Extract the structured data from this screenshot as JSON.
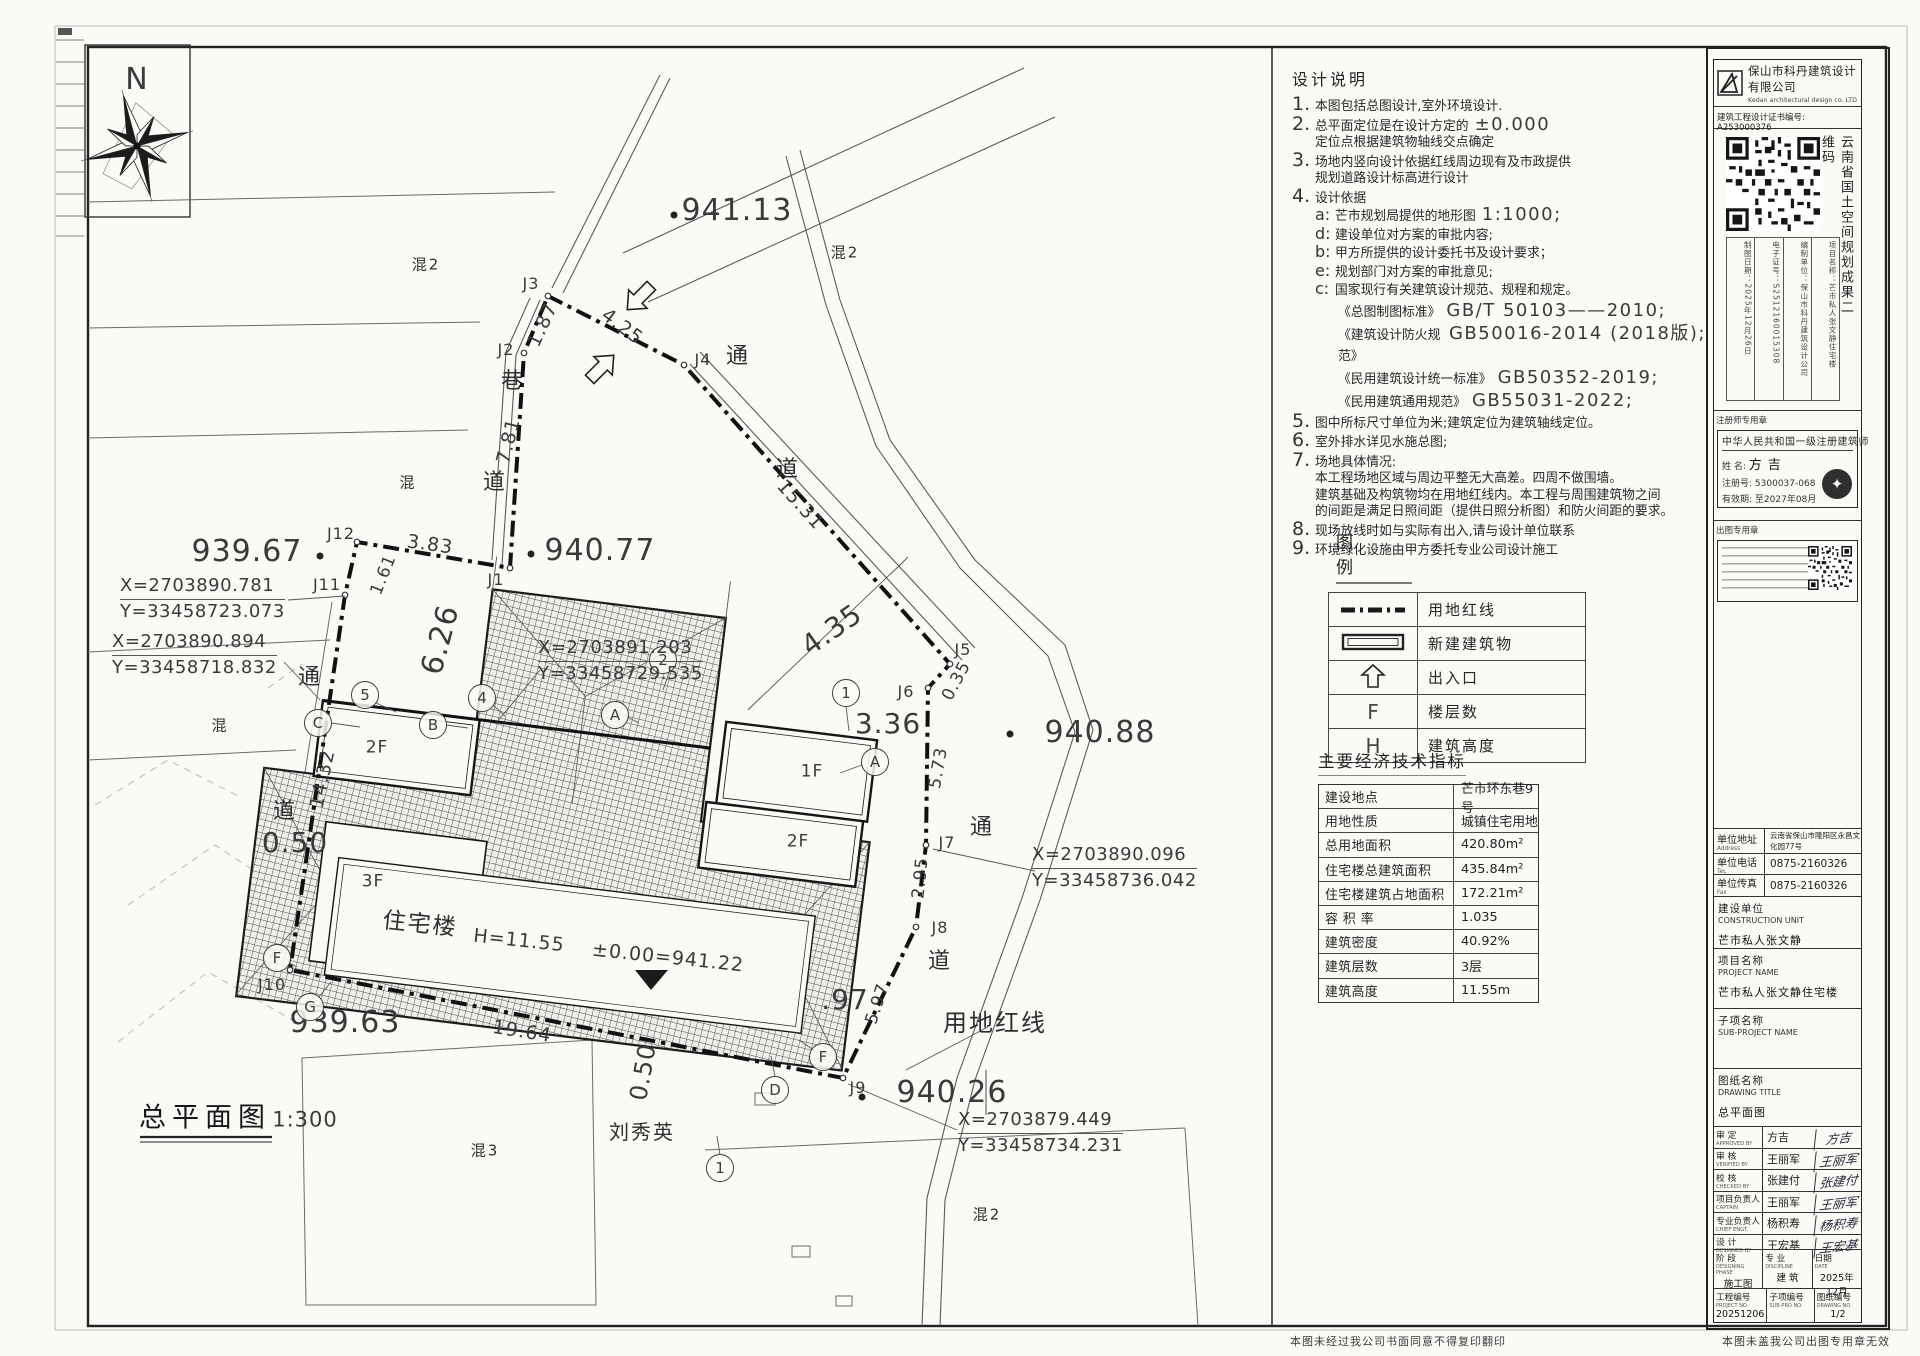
{
  "plan": {
    "north_label": "N",
    "labels": [
      {
        "t": "941.13",
        "x": 737,
        "y": 211,
        "s": 30,
        "name": "spot-elevation"
      },
      {
        "t": "940.77",
        "x": 600,
        "y": 551,
        "s": 30,
        "name": "spot-elevation"
      },
      {
        "t": "939.67",
        "x": 247,
        "y": 552,
        "s": 30,
        "name": "spot-elevation"
      },
      {
        "t": "940.88",
        "x": 1100,
        "y": 733,
        "s": 30,
        "name": "spot-elevation"
      },
      {
        "t": "939.63",
        "x": 345,
        "y": 1023,
        "s": 30,
        "name": "spot-elevation"
      },
      {
        "t": "940.26",
        "x": 952,
        "y": 1093,
        "s": 30,
        "name": "spot-elevation"
      },
      {
        "t": ".97",
        "x": 845,
        "y": 1000,
        "s": 28,
        "name": "spot-elevation"
      },
      {
        "t": "6.26",
        "x": 441,
        "y": 640,
        "s": 30,
        "r": -75,
        "name": "dimension"
      },
      {
        "t": "4.35",
        "x": 832,
        "y": 630,
        "s": 28,
        "r": -35,
        "name": "dimension"
      },
      {
        "t": "3.36",
        "x": 888,
        "y": 724,
        "s": 28,
        "name": "dimension"
      },
      {
        "t": "0.50",
        "x": 295,
        "y": 843,
        "s": 28,
        "name": "dimension"
      },
      {
        "t": "0.50",
        "x": 643,
        "y": 1072,
        "s": 24,
        "r": -80,
        "name": "dimension"
      },
      {
        "t": "1.87",
        "x": 543,
        "y": 325,
        "s": 19,
        "r": -65,
        "name": "dimension"
      },
      {
        "t": "4.25",
        "x": 622,
        "y": 327,
        "s": 19,
        "r": 37,
        "name": "dimension"
      },
      {
        "t": "15.31",
        "x": 800,
        "y": 505,
        "s": 19,
        "r": 48,
        "name": "dimension"
      },
      {
        "t": "0.35",
        "x": 957,
        "y": 681,
        "s": 17,
        "r": -62,
        "name": "dimension"
      },
      {
        "t": "5.73",
        "x": 939,
        "y": 768,
        "s": 17,
        "r": -80,
        "name": "dimension"
      },
      {
        "t": "2.95",
        "x": 921,
        "y": 878,
        "s": 17,
        "r": -84,
        "name": "dimension"
      },
      {
        "t": "5.97",
        "x": 878,
        "y": 1004,
        "s": 17,
        "r": -72,
        "name": "dimension"
      },
      {
        "t": "19.64",
        "x": 522,
        "y": 1032,
        "s": 19,
        "r": 9,
        "name": "dimension"
      },
      {
        "t": "14.32",
        "x": 323,
        "y": 779,
        "s": 19,
        "r": -78,
        "name": "dimension"
      },
      {
        "t": "3.83",
        "x": 430,
        "y": 545,
        "s": 19,
        "r": 8,
        "name": "dimension"
      },
      {
        "t": "1.61",
        "x": 384,
        "y": 575,
        "s": 17,
        "r": -68,
        "name": "dimension"
      },
      {
        "t": "7.81",
        "x": 509,
        "y": 441,
        "s": 19,
        "r": -76,
        "name": "dimension"
      },
      {
        "t": "J1",
        "x": 496,
        "y": 580,
        "s": 16,
        "name": "boundary-point-label"
      },
      {
        "t": "J2",
        "x": 506,
        "y": 350,
        "s": 16,
        "name": "boundary-point-label"
      },
      {
        "t": "J3",
        "x": 531,
        "y": 284,
        "s": 16,
        "name": "boundary-point-label"
      },
      {
        "t": "J4",
        "x": 703,
        "y": 360,
        "s": 16,
        "name": "boundary-point-label"
      },
      {
        "t": "J5",
        "x": 963,
        "y": 650,
        "s": 16,
        "name": "boundary-point-label"
      },
      {
        "t": "J6",
        "x": 906,
        "y": 692,
        "s": 16,
        "name": "boundary-point-label"
      },
      {
        "t": "J7",
        "x": 947,
        "y": 843,
        "s": 16,
        "name": "boundary-point-label"
      },
      {
        "t": "J8",
        "x": 940,
        "y": 928,
        "s": 16,
        "name": "boundary-point-label"
      },
      {
        "t": "J9",
        "x": 858,
        "y": 1088,
        "s": 16,
        "name": "boundary-point-label"
      },
      {
        "t": "J10",
        "x": 272,
        "y": 985,
        "s": 16,
        "name": "boundary-point-label"
      },
      {
        "t": "J11",
        "x": 327,
        "y": 585,
        "s": 16,
        "name": "boundary-point-label"
      },
      {
        "t": "J12",
        "x": 341,
        "y": 534,
        "s": 16,
        "name": "boundary-point-label"
      },
      {
        "t": "N",
        "x": 137,
        "y": 80,
        "s": 30,
        "name": "north-letter"
      },
      {
        "t": "巷",
        "x": 513,
        "y": 382,
        "s": 22,
        "c": "cn",
        "name": "road-label"
      },
      {
        "t": "道",
        "x": 495,
        "y": 483,
        "s": 22,
        "c": "cn",
        "name": "road-label"
      },
      {
        "t": "通",
        "x": 738,
        "y": 357,
        "s": 22,
        "c": "cn",
        "name": "road-label"
      },
      {
        "t": "道",
        "x": 788,
        "y": 470,
        "s": 22,
        "c": "cn",
        "name": "road-label"
      },
      {
        "t": "通",
        "x": 310,
        "y": 678,
        "s": 22,
        "c": "cn",
        "name": "road-label"
      },
      {
        "t": "道",
        "x": 285,
        "y": 812,
        "s": 22,
        "c": "cn",
        "name": "road-label"
      },
      {
        "t": "通",
        "x": 982,
        "y": 828,
        "s": 22,
        "c": "cn",
        "name": "road-label"
      },
      {
        "t": "道",
        "x": 940,
        "y": 962,
        "s": 22,
        "c": "cn",
        "name": "road-label"
      },
      {
        "t": "混2",
        "x": 426,
        "y": 265,
        "s": 15,
        "c": "cn",
        "name": "parcel-label"
      },
      {
        "t": "混2",
        "x": 845,
        "y": 253,
        "s": 15,
        "c": "cn",
        "name": "parcel-label"
      },
      {
        "t": "混",
        "x": 408,
        "y": 483,
        "s": 15,
        "c": "cn",
        "name": "parcel-label"
      },
      {
        "t": "混",
        "x": 220,
        "y": 726,
        "s": 15,
        "c": "cn",
        "name": "parcel-label"
      },
      {
        "t": "混3",
        "x": 485,
        "y": 1151,
        "s": 15,
        "c": "cn",
        "name": "parcel-label"
      },
      {
        "t": "混2",
        "x": 987,
        "y": 1215,
        "s": 15,
        "c": "cn",
        "name": "parcel-label"
      },
      {
        "t": "刘秀英",
        "x": 642,
        "y": 1132,
        "s": 20,
        "c": "cn",
        "name": "neighbor-owner-label"
      },
      {
        "t": "用地红线",
        "x": 995,
        "y": 1023,
        "s": 24,
        "c": "cn",
        "name": "red-line-label"
      },
      {
        "t": "住宅楼",
        "x": 420,
        "y": 925,
        "s": 23,
        "r": 6,
        "c": "cn",
        "name": "building-name"
      },
      {
        "t": "H=11.55",
        "x": 519,
        "y": 941,
        "s": 19,
        "r": 6,
        "name": "building-height"
      },
      {
        "t": "±0.00=941.22",
        "x": 668,
        "y": 958,
        "s": 19,
        "r": 6,
        "name": "building-datum"
      },
      {
        "t": "2F",
        "x": 377,
        "y": 748,
        "s": 17,
        "name": "floor-label"
      },
      {
        "t": "3F",
        "x": 373,
        "y": 882,
        "s": 17,
        "name": "floor-label"
      },
      {
        "t": "1F",
        "x": 812,
        "y": 772,
        "s": 17,
        "name": "floor-label"
      },
      {
        "t": "2F",
        "x": 798,
        "y": 842,
        "s": 17,
        "name": "floor-label"
      },
      {
        "t": "总平面图",
        "x": 205,
        "y": 1118,
        "s": 27,
        "c": "cnb",
        "name": "drawing-title-label"
      },
      {
        "t": "1:300",
        "x": 305,
        "y": 1120,
        "s": 21,
        "name": "drawing-scale"
      }
    ],
    "bubbles": [
      {
        "t": "C",
        "x": 318,
        "y": 723
      },
      {
        "t": "5",
        "x": 365,
        "y": 695
      },
      {
        "t": "B",
        "x": 433,
        "y": 725
      },
      {
        "t": "4",
        "x": 482,
        "y": 698
      },
      {
        "t": "A",
        "x": 615,
        "y": 715
      },
      {
        "t": "2",
        "x": 663,
        "y": 660
      },
      {
        "t": "1",
        "x": 846,
        "y": 693
      },
      {
        "t": "A",
        "x": 875,
        "y": 762
      },
      {
        "t": "D",
        "x": 775,
        "y": 1090
      },
      {
        "t": "G",
        "x": 310,
        "y": 1007
      },
      {
        "t": "F",
        "x": 277,
        "y": 958
      },
      {
        "t": "F",
        "x": 823,
        "y": 1057
      },
      {
        "t": "1",
        "x": 720,
        "y": 1168
      }
    ],
    "coord_blocks": [
      {
        "x1": "X=2703890.781",
        "y1": "Y=33458723.073",
        "px": 120,
        "py": 574
      },
      {
        "x1": "X=2703890.894",
        "y1": "Y=33458718.832",
        "px": 112,
        "py": 630
      },
      {
        "x1": "X=2703891.203",
        "y1": "Y=33458729.535",
        "px": 538,
        "py": 636
      },
      {
        "x1": "X=2703890.096",
        "y1": "Y=33458736.042",
        "px": 1032,
        "py": 843
      },
      {
        "x1": "X=2703879.449",
        "y1": "Y=33458734.231",
        "px": 958,
        "py": 1108
      }
    ]
  },
  "notes": {
    "title": "设计说明",
    "items": [
      {
        "k": "n",
        "n": "1.",
        "t": "本图包括总图设计,室外环境设计."
      },
      {
        "k": "n",
        "n": "2.",
        "t": "总平面定位是在设计方定的",
        "code": "±0.000"
      },
      {
        "k": "c",
        "t": "定位点根据建筑物轴线交点确定"
      },
      {
        "k": "n",
        "n": "3.",
        "t": "场地内竖向设计依据红线周边现有及市政提供"
      },
      {
        "k": "c",
        "t": "规划道路设计标高进行设计"
      },
      {
        "k": "n",
        "n": "4.",
        "t": "设计依据"
      },
      {
        "k": "s",
        "n": "a:",
        "t": "芒市规划局提供的地形图",
        "code": "1:1000;"
      },
      {
        "k": "s",
        "n": "d:",
        "t": "建设单位对方案的审批内容;"
      },
      {
        "k": "s",
        "n": "b:",
        "t": "甲方所提供的设计委托书及设计要求；"
      },
      {
        "k": "s",
        "n": "e:",
        "t": "规划部门对方案的审批意见;"
      },
      {
        "k": "s",
        "n": "c:",
        "t": "国家现行有关建筑设计规范、规程和规定。"
      },
      {
        "k": "std",
        "t": "《总图制图标准》",
        "code": "GB/T 50103——2010;"
      },
      {
        "k": "std",
        "t": "《建筑设计防火规范》",
        "code": "GB50016-2014 (2018版);"
      },
      {
        "k": "std",
        "t": "《民用建筑设计统一标准》",
        "code": "GB50352-2019;"
      },
      {
        "k": "std",
        "t": "《民用建筑通用规范》",
        "code": "GB55031-2022;"
      },
      {
        "k": "n",
        "n": "5.",
        "t": "图中所标尺寸单位为米;建筑定位为建筑轴线定位。"
      },
      {
        "k": "n",
        "n": "6.",
        "t": "室外排水详见水施总图;"
      },
      {
        "k": "n",
        "n": "7.",
        "t": "场地具体情况:"
      },
      {
        "k": "c",
        "t": "本工程场地区域与周边平整无大高差。四周不做围墙。"
      },
      {
        "k": "c",
        "t": "建筑基础及构筑物均在用地红线内。本工程与周围建筑物之间"
      },
      {
        "k": "c",
        "t": "的间距是满足日照间距（提供日照分析图）和防火间距的要求。"
      },
      {
        "k": "n",
        "n": "8.",
        "t": "现场放线时如与实际有出入,请与设计单位联系"
      },
      {
        "k": "n",
        "n": "9.",
        "t": "环境绿化设施由甲方委托专业公司设计施工"
      }
    ]
  },
  "legend": {
    "title": "图  例",
    "rows": [
      {
        "label": "用地红线"
      },
      {
        "label": "新建建筑物"
      },
      {
        "label": "出入口"
      },
      {
        "label": "楼层数",
        "letter": "F"
      },
      {
        "label": "建筑高度",
        "letter": "H"
      }
    ]
  },
  "econ": {
    "title": "主要经济技术指标",
    "rows": [
      {
        "label": "建设地点",
        "value": "芒市环东巷9号"
      },
      {
        "label": "用地性质",
        "value": "城镇住宅用地"
      },
      {
        "label": "总用地面积",
        "value": "420.80m²"
      },
      {
        "label": "住宅楼总建筑面积",
        "value": "435.84m²"
      },
      {
        "label": "住宅楼建筑占地面积",
        "value": "172.21m²"
      },
      {
        "label": "容 积 率",
        "value": "1.035"
      },
      {
        "label": "建筑密度",
        "value": "40.92%"
      },
      {
        "label": "建筑层数",
        "value": "3层"
      },
      {
        "label": "建筑高度",
        "value": "11.55m"
      }
    ]
  },
  "titleblock": {
    "company_cn": "保山市科丹建筑设计有限公司",
    "company_en": "Kedan architectural design co. LTD",
    "cert": "建筑工程设计证书编号: A253000376",
    "qr_caption": "云南省国土空间规划成果二维码",
    "qr_cols": [
      "制图日期：2025年12月26日",
      "电子证号：S2512160015308",
      "编制单位：保山市科丹建筑设计公司",
      "项目名称：芒市私人张文静住宅楼"
    ],
    "stamp1_header": "注册师专用章",
    "stamp1_line1": "中华人民共和国一级注册建筑师",
    "stamp1_name_l": "姓 名:",
    "stamp1_name": "方吉",
    "stamp1_reg_l": "注册号:",
    "stamp1_reg": "5300037-068",
    "stamp1_valid_l": "有效期:",
    "stamp1_valid": "至2027年08月",
    "stamp2_header": "出图专用章",
    "addr_l": "单位地址",
    "addr_e": "Address",
    "addr_v": "云南省保山市隆阳区永昌文化园77号",
    "tel_l": "单位电话",
    "tel_e": "TeL",
    "tel_v": "0875-2160326",
    "fax_l": "单位传真",
    "fax_e": "Fax",
    "fax_v": "0875-2160326",
    "cunit_l": "建设单位",
    "cunit_e": "CONSTRUCTION UNIT",
    "cunit_v": "芒市私人张文静",
    "pname_l": "项目名称",
    "pname_e": "PROJECT NAME",
    "pname_v": "芒市私人张文静住宅楼",
    "sub_l": "子项名称",
    "sub_e": "SUB-PROJECT NAME",
    "sub_v": "",
    "dt_l": "图纸名称",
    "dt_e": "DRAWING TITLE",
    "dt_v": "总平面图",
    "sig_rows": [
      {
        "l": "审 定",
        "e": "APPROVED BY",
        "n": "方吉",
        "s": "方吉"
      },
      {
        "l": "审 核",
        "e": "VERIFIED BY",
        "n": "王丽军",
        "s": "王丽军"
      },
      {
        "l": "校 核",
        "e": "CHECKED BY",
        "n": "张建付",
        "s": "张建付"
      },
      {
        "l": "项目负责人",
        "e": "CAPTAIN",
        "n": "王丽军",
        "s": "王丽军"
      },
      {
        "l": "专业负责人",
        "e": "CHIEF ENGT.",
        "n": "杨积寿",
        "s": "杨积寿"
      },
      {
        "l": "设 计",
        "e": "DESIGNED BY",
        "n": "王宏基",
        "s": "王宏基"
      }
    ],
    "phase": [
      {
        "l": "阶 段",
        "e": "DESIGNING PHASE",
        "v": "施工图"
      },
      {
        "l": "专 业",
        "e": "DISCIPLINE",
        "v": "建 筑"
      },
      {
        "l": "日期",
        "e": "DATE",
        "v": "2025年12月"
      }
    ],
    "nums": [
      {
        "l": "工程编号",
        "e": "PROJECT NO.",
        "v": "20251206"
      },
      {
        "l": "子项编号",
        "e": "SUB-PRO NO.",
        "v": ""
      },
      {
        "l": "图纸编号",
        "e": "DRAWING NO.",
        "v": "1/2"
      }
    ],
    "footer_left": "本图未经过我公司书面同意不得复印翻印",
    "footer_right": "本图未盖我公司出图专用章无效"
  }
}
